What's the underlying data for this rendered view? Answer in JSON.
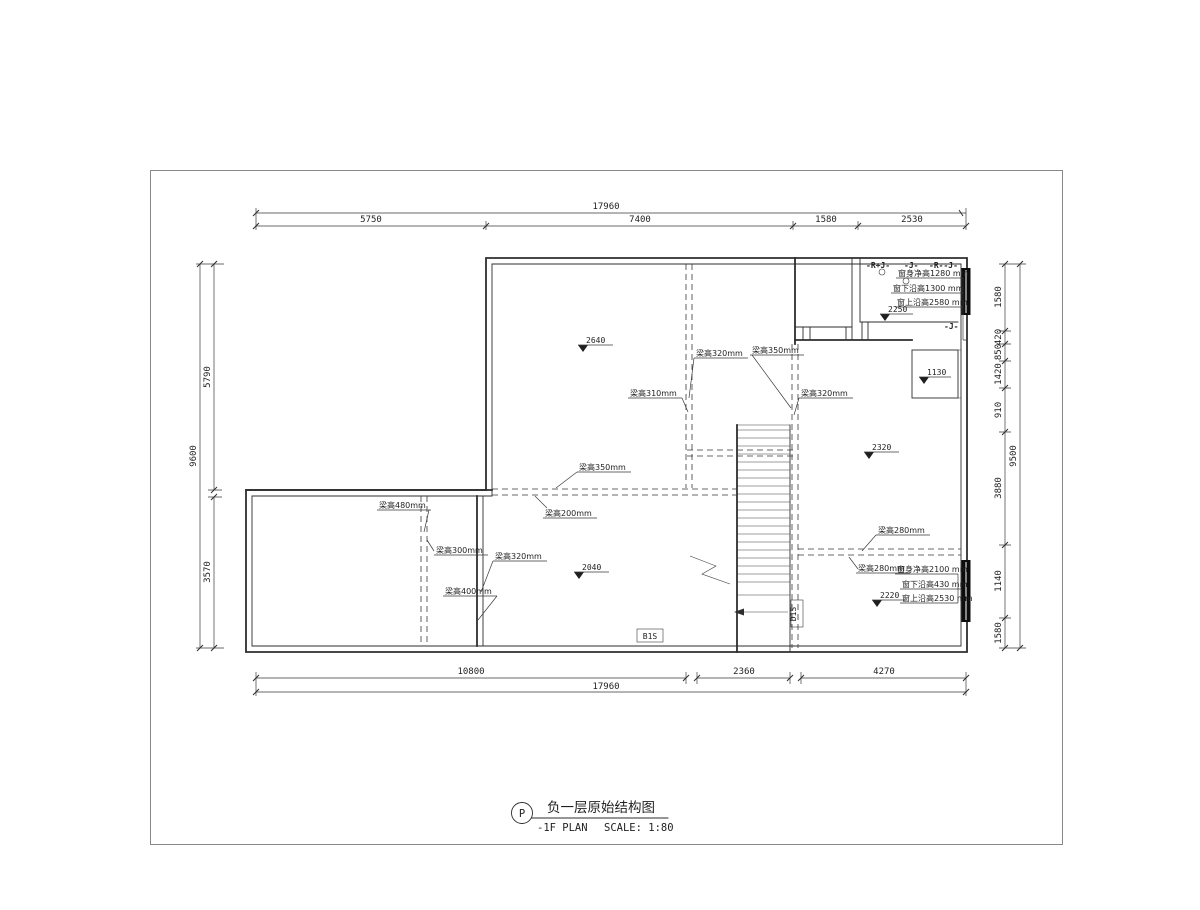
{
  "title_block": {
    "tag": "P",
    "title_cn": "负一层原始结构图",
    "title_en": "-1F PLAN",
    "scale": "SCALE: 1:80"
  },
  "dimensions": {
    "top": {
      "overall": "17960",
      "segments": [
        "5750",
        "7400",
        "1580",
        "2530"
      ]
    },
    "bottom": {
      "overall": "17960",
      "segments": [
        "10800",
        "2360",
        "4270"
      ]
    },
    "left": {
      "overall": "9600",
      "segments": [
        "5790",
        "3570"
      ]
    },
    "right": {
      "overall": "9500",
      "segments": [
        "1580",
        "420",
        "850",
        "1420",
        "910",
        "3880",
        "1140",
        "1580"
      ]
    }
  },
  "elevations": [
    "2640",
    "2040",
    "2320",
    "1130",
    "2250",
    "2220"
  ],
  "beam_labels": [
    "梁高320mm",
    "梁高350mm",
    "梁高310mm",
    "梁高320mm",
    "梁高350mm",
    "梁高200mm",
    "梁高480mm",
    "梁高300mm",
    "梁高320mm",
    "梁高400mm",
    "梁高280mm",
    "梁高280mm"
  ],
  "window_annotations": {
    "top": [
      "窗身净高1280 mm",
      "窗下沿高1300 mm",
      "窗上沿高2580 mm"
    ],
    "bottom": [
      "窗身净高2100 mm",
      "窗下沿高430 mm",
      "窗上沿高2530 mm"
    ]
  },
  "zone_tags": [
    "-R+J-",
    "-J-",
    "-R--J-",
    "-J-"
  ],
  "door_tags": [
    "B1S",
    "D1S"
  ]
}
